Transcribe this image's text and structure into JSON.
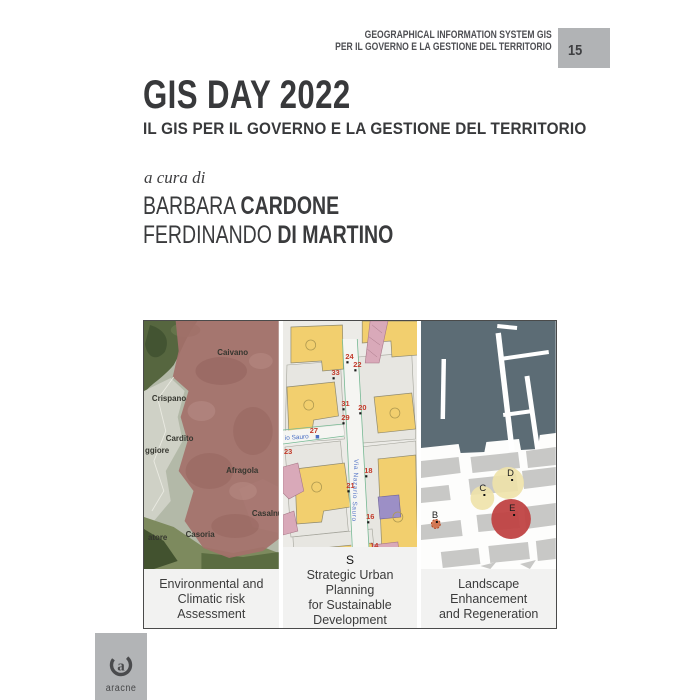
{
  "series": {
    "line1": "GEOGRAPHICAL INFORMATION SYSTEM GIS",
    "line2": "PER IL GOVERNO E LA GESTIONE DEL TERRITORIO",
    "number": "15",
    "badge_color": "#b1b3b5"
  },
  "title": {
    "main": "GIS DAY 2022",
    "subtitle": "IL GIS PER IL GOVERNO E LA GESTIONE DEL TERRITORIO"
  },
  "editors": {
    "prefix": "a cura di",
    "authors": [
      {
        "first": "BARBARA",
        "last": "CARDONE"
      },
      {
        "first": "FERDINANDO",
        "last": "DI MARTINO"
      }
    ]
  },
  "panels": [
    {
      "caption": [
        "Environmental and",
        "Climatic risk Assessment"
      ],
      "overlay_color": "#a4706a",
      "labels": [
        {
          "t": "Caivano",
          "x": 74,
          "y": 34
        },
        {
          "t": "Crispano",
          "x": 8,
          "y": 80
        },
        {
          "t": "Cardito",
          "x": 22,
          "y": 120
        },
        {
          "t": "ggiore",
          "x": 1,
          "y": 132
        },
        {
          "t": "Afragola",
          "x": 83,
          "y": 152
        },
        {
          "t": "Casalnu",
          "x": 109,
          "y": 195
        },
        {
          "t": "Casoria",
          "x": 42,
          "y": 216
        },
        {
          "t": "atore",
          "x": 4,
          "y": 219
        }
      ]
    },
    {
      "caption": [
        "Strategic Urban Planning",
        "for Sustainable Development"
      ],
      "s_marker": "S",
      "street_label": "Via Nazario Sauro",
      "street_label_partial": "io Sauro",
      "number_color": "#c23a2a",
      "numbers": [
        {
          "t": "24",
          "x": 63,
          "y": 38,
          "dot": true
        },
        {
          "t": "22",
          "x": 71,
          "y": 46,
          "dot": true
        },
        {
          "t": "33",
          "x": 49,
          "y": 54,
          "dot": true
        },
        {
          "t": "31",
          "x": 59,
          "y": 85,
          "dot": true
        },
        {
          "t": "29",
          "x": 59,
          "y": 99,
          "dot": true
        },
        {
          "t": "20",
          "x": 76,
          "y": 89,
          "dot": true
        },
        {
          "t": "27",
          "x": 27,
          "y": 112,
          "dot": false
        },
        {
          "t": "23",
          "x": 1,
          "y": 133,
          "dot": false
        },
        {
          "t": "18",
          "x": 82,
          "y": 152,
          "dot": true
        },
        {
          "t": "21",
          "x": 64,
          "y": 167,
          "dot": true
        },
        {
          "t": "16",
          "x": 84,
          "y": 198,
          "dot": true
        },
        {
          "t": "14",
          "x": 88,
          "y": 227,
          "dot": true
        },
        {
          "t": "19",
          "x": 72,
          "y": 238,
          "dot": true
        }
      ]
    },
    {
      "caption": [
        "Landscape Enhancement",
        "and Regeneration"
      ],
      "points": [
        {
          "label": "B",
          "x": 11,
          "y": 197,
          "cx": 15,
          "cy": 203,
          "r": 4.5,
          "fill": "#d2693e",
          "opacity": 0.85,
          "stroke": "#b04a28"
        },
        {
          "label": "C",
          "x": 59,
          "y": 170,
          "cx": 62,
          "cy": 177,
          "r": 12,
          "fill": "#eee2a9",
          "opacity": 0.9,
          "stroke": "none"
        },
        {
          "label": "D",
          "x": 87,
          "y": 155,
          "cx": 88,
          "cy": 162,
          "r": 16,
          "fill": "#eee2a9",
          "opacity": 0.9,
          "stroke": "none"
        },
        {
          "label": "E",
          "x": 89,
          "y": 190,
          "cx": 91,
          "cy": 198,
          "r": 20,
          "fill": "#c04343",
          "opacity": 0.95,
          "stroke": "none"
        }
      ]
    }
  ],
  "publisher": {
    "name": "aracne",
    "box_color": "#b2b4b6"
  }
}
